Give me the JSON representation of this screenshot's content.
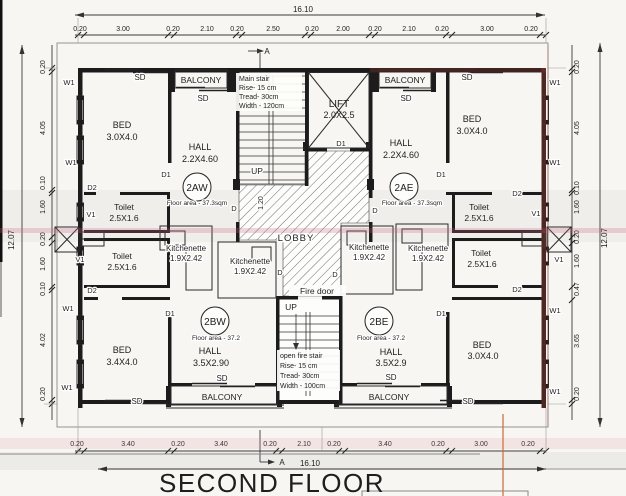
{
  "document": {
    "title": "SECOND FLOOR"
  },
  "dims": {
    "top_total": "16.10",
    "bottom_total": "16.10",
    "left_total": "12.07",
    "right_total": "12.07",
    "stair_width": "1.20",
    "top": [
      "0.20",
      "3.00",
      "0.20",
      "2.10",
      "0.20",
      "2.50",
      "0.20",
      "2.00",
      "0.20",
      "2.10",
      "0.20",
      "3.00",
      "0.20"
    ],
    "bottom": [
      "0.20",
      "3.40",
      "0.20",
      "3.40",
      "0.20",
      "2.10",
      "0.20",
      "3.40",
      "0.20",
      "3.00",
      "0.20"
    ],
    "left": [
      "0.20",
      "4.05",
      "0.10",
      "1.60",
      "0.20",
      "1.60",
      "0.10",
      "4.02",
      "0.20"
    ],
    "right": [
      "0.20",
      "4.05",
      "0.10",
      "1.60",
      "0.20",
      "1.60",
      "0.47",
      "3.65",
      "0.20"
    ]
  },
  "section": {
    "label": "A"
  },
  "core": {
    "lift_name": "LIFT",
    "lift_size": "2.0X2.5",
    "lobby": "LOBBY",
    "fire_door": "Fire door",
    "up": "UP",
    "main_stair_note": {
      "l1": "Main stair",
      "l2": "Rise- 15 cm",
      "l3": "Tread- 30cm",
      "l4": "Width - 120cm"
    },
    "fire_stair_note": {
      "l1": "open fire stair",
      "l2": "Rise- 15 cm",
      "l3": "Tread- 30cm",
      "l4": "Width - 100cm"
    }
  },
  "tags": {
    "window": "W1",
    "vent": "V1",
    "door": "D",
    "door1": "D1",
    "door2": "D2",
    "sliding": "SD",
    "balcony": "BALCONY"
  },
  "units": {
    "aw": {
      "id": "2AW",
      "area": "Floor area - 37.3sqm",
      "bed_name": "BED",
      "bed_size": "3.0X4.0",
      "hall_name": "HALL",
      "hall_size": "2.2X4.60",
      "toilet_name": "Toilet",
      "toilet_size": "2.5X1.6",
      "kitchen_name": "Kitchenette",
      "kitchen_size": "1.9X2.42"
    },
    "ae": {
      "id": "2AE",
      "area": "Floor area - 37.3sqm",
      "bed_name": "BED",
      "bed_size": "3.0X4.0",
      "hall_name": "HALL",
      "hall_size": "2.2X4.60",
      "toilet_name": "Toilet",
      "toilet_size": "2.5X1.6",
      "kitchen_name": "Kitchenette",
      "kitchen_size": "1.9X2.42"
    },
    "bw": {
      "id": "2BW",
      "area": "Floor area - 37.2",
      "bed_name": "BED",
      "bed_size": "3.4X4.0",
      "hall_name": "HALL",
      "hall_size": "3.5X2.90",
      "toilet_name": "Toilet",
      "toilet_size": "2.5X1.6",
      "kitchen_name": "Kitchenette",
      "kitchen_size": "1.9X2.42"
    },
    "be": {
      "id": "2BE",
      "area": "Floor area - 37.2",
      "bed_name": "BED",
      "bed_size": "3.0X4.0",
      "hall_name": "HALL",
      "hall_size": "3.5X2.9",
      "toilet_name": "Toilet",
      "toilet_size": "2.5X1.6",
      "kitchen_name": "Kitchenette",
      "kitchen_size": "1.9X2.42"
    }
  }
}
